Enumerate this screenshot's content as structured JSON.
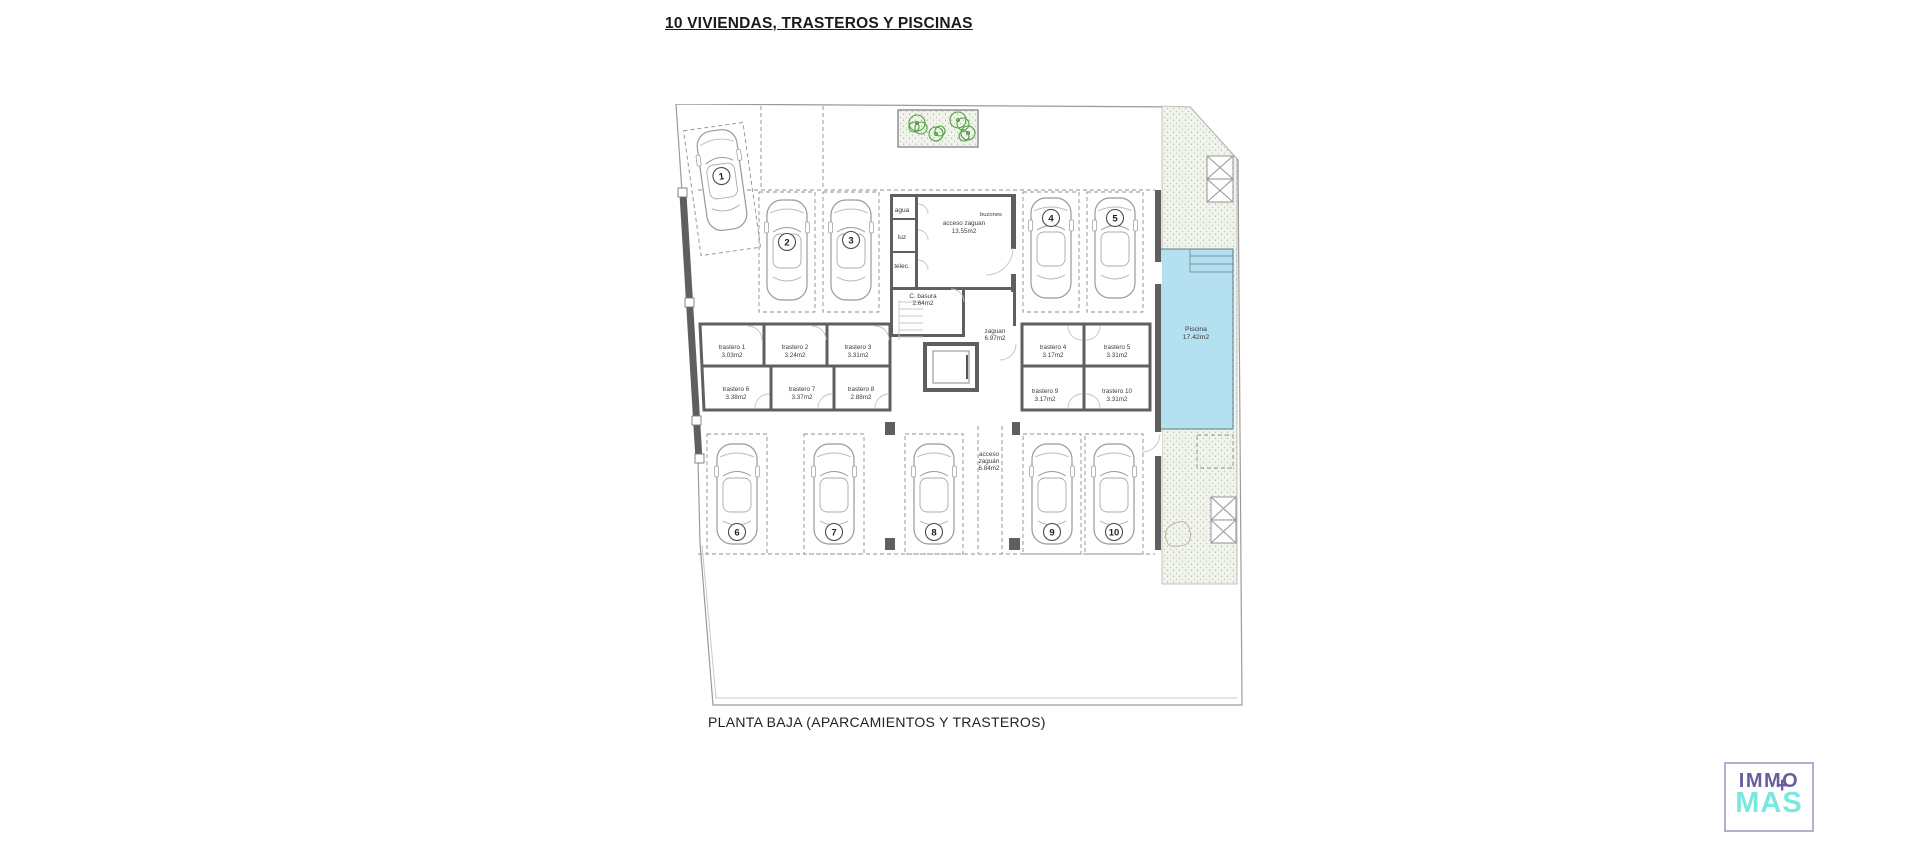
{
  "title": "10 VIVIENDAS, TRASTEROS Y PISCINAS",
  "caption": "PLANTA BAJA (APARCAMIENTOS Y TRASTEROS)",
  "colors": {
    "pool_fill": "#b5e0f0",
    "wall_gray": "#5f5f5f",
    "tree_green": "#4f9e40",
    "logo_purple": "#685e9d",
    "logo_turquoise": "#7be7e1"
  },
  "plan": {
    "parking": [
      {
        "number": "1"
      },
      {
        "number": "2"
      },
      {
        "number": "3"
      },
      {
        "number": "4"
      },
      {
        "number": "5"
      },
      {
        "number": "6"
      },
      {
        "number": "7"
      },
      {
        "number": "8"
      },
      {
        "number": "9"
      },
      {
        "number": "10"
      }
    ],
    "rooms": {
      "agua": {
        "label": "agua"
      },
      "luz": {
        "label": "luz"
      },
      "telec": {
        "label": "telec."
      },
      "acceso_zaguan": {
        "label": "acceso zaguan",
        "area": "13.55m2"
      },
      "buzones": {
        "label": "buzones"
      },
      "basura": {
        "label": "C. basura",
        "area": "2.64m2"
      },
      "zaguan": {
        "label": "zaguan",
        "area": "6.97m2"
      },
      "acceso_sur": {
        "label": "acceso",
        "label2": "zaguán",
        "area": "6.84m2"
      },
      "piscina": {
        "label": "Piscina",
        "area": "17.42m2"
      }
    },
    "trasteros": [
      {
        "name": "trastero 1",
        "area": "3.03m2"
      },
      {
        "name": "trastero 2",
        "area": "3.24m2"
      },
      {
        "name": "trastero 3",
        "area": "3.31m2"
      },
      {
        "name": "trastero 4",
        "area": "3.17m2"
      },
      {
        "name": "trastero 5",
        "area": "3.31m2"
      },
      {
        "name": "trastero 6",
        "area": "3.38m2"
      },
      {
        "name": "trastero 7",
        "area": "3.37m2"
      },
      {
        "name": "trastero 8",
        "area": "2.88m2"
      },
      {
        "name": "trastero 9",
        "area": "3.17m2"
      },
      {
        "name": "trastero 10",
        "area": "3.31m2"
      }
    ]
  },
  "logo": {
    "line1": "IMMO",
    "line2": "MAS",
    "plus": "+"
  }
}
